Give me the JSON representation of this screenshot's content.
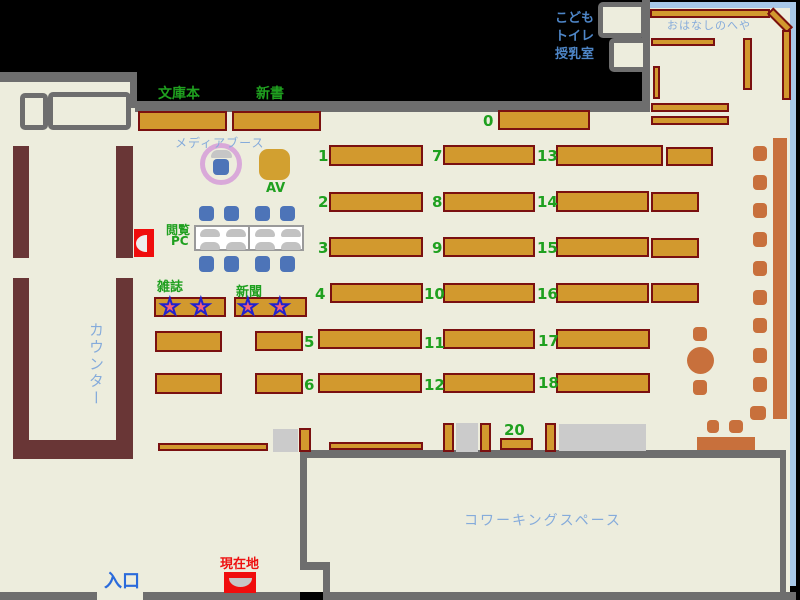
{
  "colors": {
    "background": "#000000",
    "floor": "#EDEDDD",
    "wall_gray": "#6E6E6E",
    "shelf_fill": "#D2992E",
    "shelf_border": "#7A1010",
    "counter_maroon": "#693636",
    "terracotta": "#C8703C",
    "chair_blue": "#4D74B8",
    "window_blue": "#A8C8E8",
    "label_green": "#1FA01F",
    "label_light_blue": "#85ABDB",
    "label_mid_blue": "#4E86C8",
    "label_blue": "#2B6BDB",
    "marker_red": "#F00D0D",
    "gray_block": "#CBCBCB",
    "booth_plum": "#D9A9D9",
    "av_gold": "#D2A030",
    "star_pink": "#F4607A",
    "star_outline": "#2121CE"
  },
  "icons": {
    "star": "★"
  },
  "texts": [
    {
      "name": "label-bunkobon",
      "text": "文庫本",
      "x": 158,
      "y": 83,
      "cls": "green bold fs14"
    },
    {
      "name": "label-shinsho",
      "text": "新書",
      "x": 256,
      "y": 83,
      "cls": "green bold fs14"
    },
    {
      "name": "label-media-booth",
      "text": "メディアブース",
      "x": 175,
      "y": 134,
      "cls": "lblue fs12 ls1"
    },
    {
      "name": "label-av",
      "text": "AV",
      "x": 266,
      "y": 181,
      "cls": "green bold fs13"
    },
    {
      "name": "label-etsuran",
      "text": "閲覧",
      "x": 166,
      "y": 221,
      "cls": "green bold fs12"
    },
    {
      "name": "label-pc",
      "text": "PC",
      "x": 171,
      "y": 234,
      "cls": "green bold fs12"
    },
    {
      "name": "label-zasshi",
      "text": "雑誌",
      "x": 157,
      "y": 276,
      "cls": "green bold fs13"
    },
    {
      "name": "label-shinbun",
      "text": "新聞",
      "x": 236,
      "y": 281,
      "cls": "green bold fs13"
    },
    {
      "name": "label-counter",
      "text": "カウンター",
      "x": 86,
      "y": 322,
      "cls": "lblue fs15 vert ls2"
    },
    {
      "name": "label-kodomo",
      "text": "こども",
      "x": 548,
      "y": 7,
      "cls": "mblue bold fs13",
      "w": 46
    },
    {
      "name": "label-toilet",
      "text": "トイレ",
      "x": 548,
      "y": 25,
      "cls": "mblue bold fs13",
      "w": 46
    },
    {
      "name": "label-nursing",
      "text": "授乳室",
      "x": 548,
      "y": 43,
      "cls": "mblue bold fs13",
      "w": 46
    },
    {
      "name": "label-ohanashi",
      "text": "おはなしのへや",
      "x": 667,
      "y": 17,
      "cls": "lblue fs11 ls1"
    },
    {
      "name": "label-coworking",
      "text": "コワーキングスペース",
      "x": 464,
      "y": 510,
      "cls": "lblue fs14 ls2"
    },
    {
      "name": "label-entrance",
      "text": "入口",
      "x": 104,
      "y": 567,
      "cls": "blue bold fs18"
    },
    {
      "name": "label-genzaichi",
      "text": "現在地",
      "x": 220,
      "y": 553,
      "cls": "redt bold fs13"
    }
  ],
  "shelves": {
    "numbered": [
      {
        "label": "0",
        "lx": 483,
        "ly": 112,
        "x": 498,
        "y": 110,
        "w": 92,
        "h": 20
      },
      {
        "label": "1",
        "lx": 318,
        "ly": 147,
        "x": 329,
        "y": 145,
        "w": 94,
        "h": 21
      },
      {
        "label": "7",
        "lx": 432,
        "ly": 147,
        "x": 443,
        "y": 145,
        "w": 92,
        "h": 20
      },
      {
        "label": "13",
        "lx": 537,
        "ly": 147,
        "x": 556,
        "y": 145,
        "w": 107,
        "h": 21
      },
      {
        "label": "2",
        "lx": 318,
        "ly": 193,
        "x": 329,
        "y": 192,
        "w": 94,
        "h": 20
      },
      {
        "label": "8",
        "lx": 432,
        "ly": 193,
        "x": 443,
        "y": 192,
        "w": 92,
        "h": 20
      },
      {
        "label": "14",
        "lx": 537,
        "ly": 193,
        "x": 556,
        "y": 191,
        "w": 93,
        "h": 21
      },
      {
        "label": "3",
        "lx": 318,
        "ly": 239,
        "x": 329,
        "y": 237,
        "w": 94,
        "h": 20
      },
      {
        "label": "9",
        "lx": 432,
        "ly": 239,
        "x": 443,
        "y": 237,
        "w": 92,
        "h": 20
      },
      {
        "label": "15",
        "lx": 537,
        "ly": 239,
        "x": 556,
        "y": 237,
        "w": 93,
        "h": 20
      },
      {
        "label": "4",
        "lx": 315,
        "ly": 285,
        "x": 330,
        "y": 283,
        "w": 93,
        "h": 20
      },
      {
        "label": "10",
        "lx": 424,
        "ly": 285,
        "x": 443,
        "y": 283,
        "w": 92,
        "h": 20
      },
      {
        "label": "16",
        "lx": 537,
        "ly": 285,
        "x": 556,
        "y": 283,
        "w": 93,
        "h": 20
      },
      {
        "label": "5",
        "lx": 304,
        "ly": 333,
        "x": 318,
        "y": 329,
        "w": 104,
        "h": 20
      },
      {
        "label": "11",
        "lx": 424,
        "ly": 334,
        "x": 443,
        "y": 329,
        "w": 92,
        "h": 20
      },
      {
        "label": "17",
        "lx": 538,
        "ly": 332,
        "x": 556,
        "y": 329,
        "w": 94,
        "h": 20
      },
      {
        "label": "6",
        "lx": 304,
        "ly": 376,
        "x": 318,
        "y": 373,
        "w": 104,
        "h": 20
      },
      {
        "label": "12",
        "lx": 424,
        "ly": 376,
        "x": 443,
        "y": 373,
        "w": 92,
        "h": 20
      },
      {
        "label": "18",
        "lx": 538,
        "ly": 374,
        "x": 556,
        "y": 373,
        "w": 94,
        "h": 20
      },
      {
        "label": "20",
        "lx": 504,
        "ly": 421,
        "x": 500,
        "y": 438,
        "w": 33,
        "h": 12
      }
    ],
    "plain": [
      [
        138,
        111,
        89,
        20
      ],
      [
        232,
        111,
        89,
        20
      ],
      [
        666,
        147,
        47,
        19
      ],
      [
        651,
        192,
        48,
        20
      ],
      [
        651,
        238,
        48,
        20
      ],
      [
        651,
        283,
        48,
        20
      ],
      [
        154,
        297,
        72,
        20
      ],
      [
        234,
        297,
        73,
        20
      ],
      [
        155,
        331,
        67,
        21
      ],
      [
        255,
        331,
        48,
        20
      ],
      [
        155,
        373,
        67,
        21
      ],
      [
        255,
        373,
        48,
        21
      ],
      [
        299,
        428,
        12,
        24
      ],
      [
        443,
        423,
        11,
        29
      ],
      [
        480,
        423,
        11,
        29
      ],
      [
        545,
        423,
        11,
        29
      ],
      [
        158,
        443,
        110,
        8
      ],
      [
        329,
        442,
        94,
        8
      ],
      [
        650,
        9,
        120,
        9
      ],
      [
        766,
        16,
        28,
        9,
        45
      ],
      [
        782,
        30,
        9,
        70
      ],
      [
        651,
        38,
        64,
        8
      ],
      [
        743,
        38,
        9,
        52
      ],
      [
        653,
        66,
        7,
        33
      ],
      [
        651,
        103,
        78,
        9
      ],
      [
        651,
        116,
        78,
        9
      ]
    ]
  },
  "geometry": {
    "floors": [
      [
        0,
        82,
        137,
        510
      ],
      [
        135,
        112,
        655,
        480
      ],
      [
        649,
        8,
        141,
        104
      ],
      [
        97,
        592,
        46,
        8
      ]
    ],
    "walls": [
      [
        0,
        72,
        137,
        10
      ],
      [
        130,
        72,
        7,
        36
      ],
      [
        135,
        101,
        514,
        11
      ],
      [
        642,
        0,
        8,
        112
      ],
      [
        307,
        450,
        479,
        8
      ],
      [
        780,
        452,
        6,
        145
      ],
      [
        300,
        452,
        7,
        114
      ],
      [
        300,
        562,
        30,
        8
      ],
      [
        323,
        566,
        7,
        34
      ],
      [
        0,
        592,
        97,
        8
      ],
      [
        143,
        592,
        157,
        8
      ],
      [
        323,
        592,
        473,
        8
      ]
    ],
    "windows": [
      [
        650,
        2,
        146,
        6
      ],
      [
        790,
        2,
        6,
        584
      ]
    ],
    "desk_boxes": [
      [
        20,
        93,
        28,
        37
      ],
      [
        48,
        92,
        83,
        38
      ],
      [
        598,
        2,
        48,
        36
      ],
      [
        609,
        38,
        39,
        34
      ]
    ],
    "gray_blocks": [
      [
        273,
        429,
        25,
        23
      ],
      [
        456,
        423,
        22,
        29
      ],
      [
        559,
        424,
        87,
        27
      ]
    ]
  },
  "counter": {
    "bars": [
      [
        13,
        146,
        16,
        112
      ],
      [
        116,
        146,
        17,
        112
      ],
      [
        13,
        278,
        16,
        181
      ],
      [
        116,
        278,
        17,
        181
      ],
      [
        13,
        440,
        120,
        19
      ]
    ]
  },
  "furniture": {
    "window_bar": [
      773,
      138,
      14,
      281
    ],
    "round_table": [
      687,
      347,
      27,
      27
    ],
    "tables": [
      [
        697,
        437,
        58,
        13
      ]
    ],
    "chairs": [
      [
        753,
        146,
        14,
        15
      ],
      [
        753,
        175,
        14,
        15
      ],
      [
        753,
        203,
        14,
        15
      ],
      [
        753,
        232,
        14,
        15
      ],
      [
        753,
        261,
        14,
        15
      ],
      [
        753,
        290,
        14,
        15
      ],
      [
        753,
        318,
        14,
        15
      ],
      [
        753,
        348,
        14,
        15
      ],
      [
        753,
        377,
        14,
        15
      ],
      [
        750,
        406,
        16,
        14
      ],
      [
        693,
        327,
        14,
        14
      ],
      [
        693,
        380,
        14,
        15
      ],
      [
        707,
        420,
        12,
        13
      ],
      [
        729,
        420,
        14,
        13
      ]
    ]
  },
  "pc": {
    "table": [
      194,
      225,
      110,
      26
    ],
    "divider": [
      248,
      225,
      2,
      26
    ],
    "chairs": [
      [
        199,
        206,
        15,
        15
      ],
      [
        224,
        206,
        15,
        15
      ],
      [
        255,
        206,
        15,
        15
      ],
      [
        280,
        206,
        15,
        15
      ],
      [
        199,
        256,
        15,
        16
      ],
      [
        224,
        256,
        15,
        16
      ],
      [
        255,
        256,
        15,
        16
      ],
      [
        280,
        256,
        15,
        16
      ]
    ],
    "seats": [
      [
        200,
        229,
        20,
        8
      ],
      [
        226,
        229,
        20,
        8
      ],
      [
        255,
        229,
        20,
        8
      ],
      [
        281,
        229,
        20,
        8
      ],
      [
        200,
        242,
        20,
        8
      ],
      [
        226,
        242,
        20,
        8
      ],
      [
        255,
        242,
        20,
        8
      ],
      [
        281,
        242,
        20,
        8
      ]
    ]
  },
  "stars": [
    [
      160,
      296
    ],
    [
      191,
      296
    ],
    [
      238,
      296
    ],
    [
      270,
      296
    ]
  ]
}
